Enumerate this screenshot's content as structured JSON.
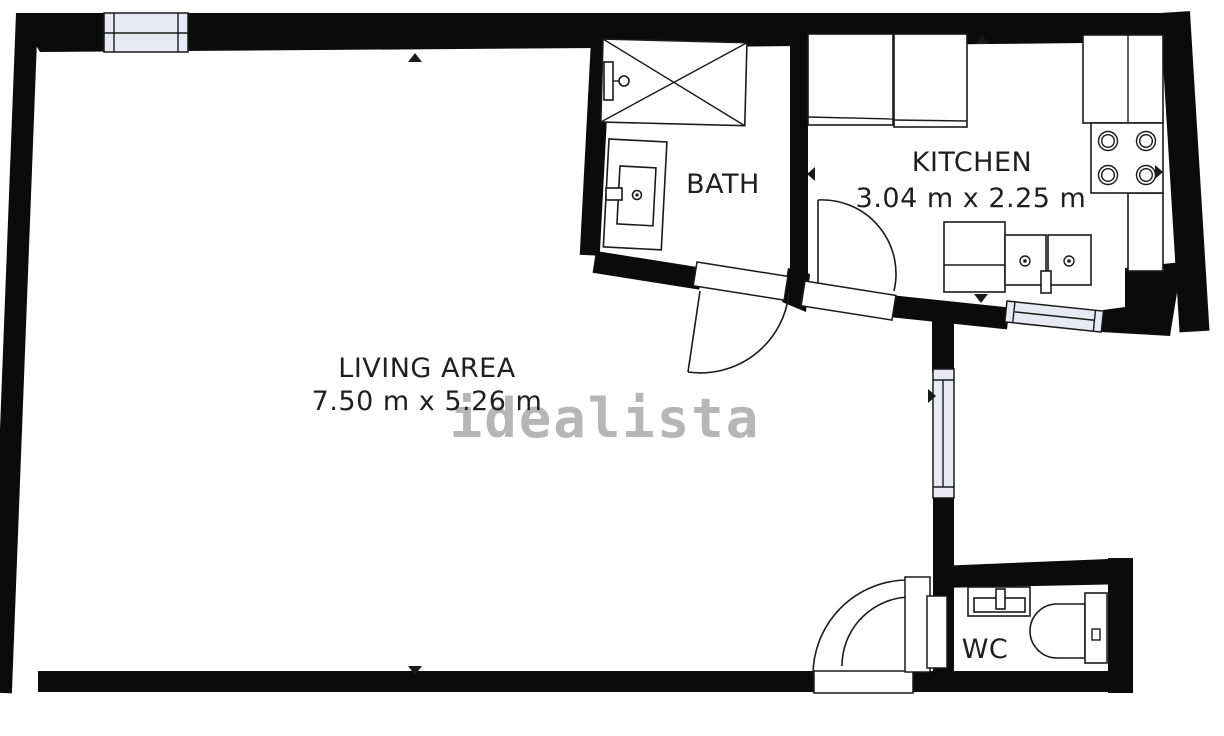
{
  "watermark": "idealista",
  "rooms": {
    "living": {
      "name": "LIVING AREA",
      "dims": "7.50 m x 5.26 m"
    },
    "kitchen": {
      "name": "KITCHEN",
      "dims": "3.04 m x 2.25 m"
    },
    "bath": {
      "name": "BATH"
    },
    "wc": {
      "name": "WC"
    }
  },
  "colors": {
    "wall": "#0b0b0b",
    "line": "#1a1a1a",
    "window": "#e9e9f5",
    "text": "#1f1f1f",
    "watermark": "#b3b3b3",
    "background": "#ffffff"
  }
}
